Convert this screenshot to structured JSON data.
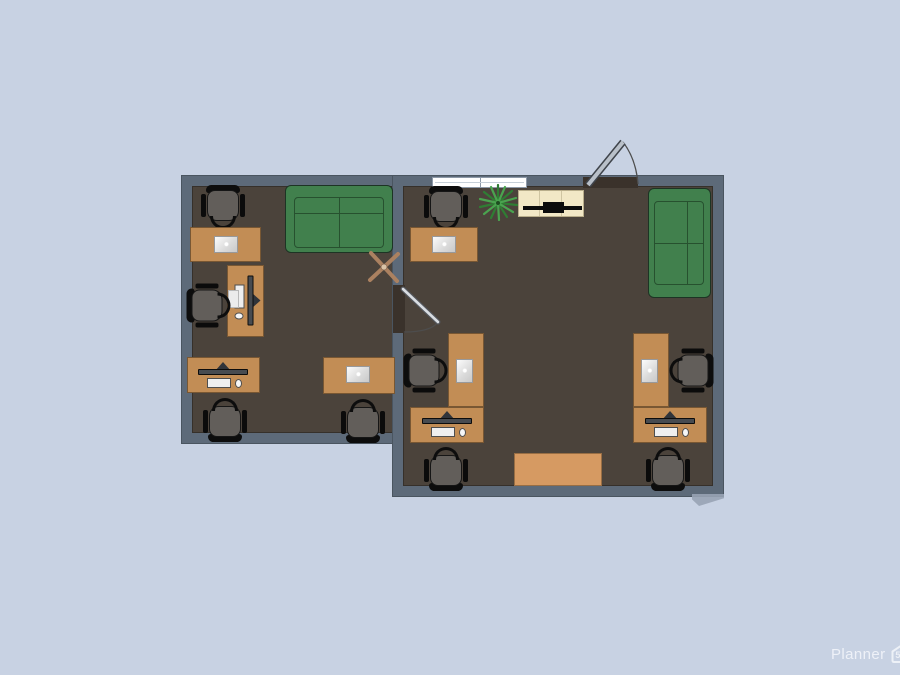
{
  "watermark": {
    "brand": "Planner",
    "badge": "5d"
  },
  "palette": {
    "background": "#c8d2e3",
    "wall": "#5d6a79",
    "wall_outline": "#4a5560",
    "floor": "#4b433b",
    "desk": "#c28d55",
    "coffee_table": "#d69a62",
    "sofa_green": "#41804d",
    "tv_stand_cream": "#f2e8c6",
    "chair_seat_gray": "#625e5a",
    "window_white": "#ffffff",
    "door_threshold_brown": "#3a322b",
    "plant_green": "#2f7d33",
    "fan_tan": "#ab8160"
  },
  "plan": {
    "rooms": [
      {
        "name": "left office",
        "furniture": [
          "office desk x4",
          "office chair x4",
          "green sofa x1",
          "desktop computer x2",
          "laptop x2",
          "ceiling fan x1"
        ]
      },
      {
        "name": "right office",
        "furniture": [
          "office desk x5",
          "office chair x5",
          "green sofa x1",
          "desktop computer x2",
          "laptop x3",
          "tv stand x1",
          "potted plant x1",
          "coffee table x1"
        ]
      }
    ],
    "doors": 2,
    "windows": 1
  }
}
